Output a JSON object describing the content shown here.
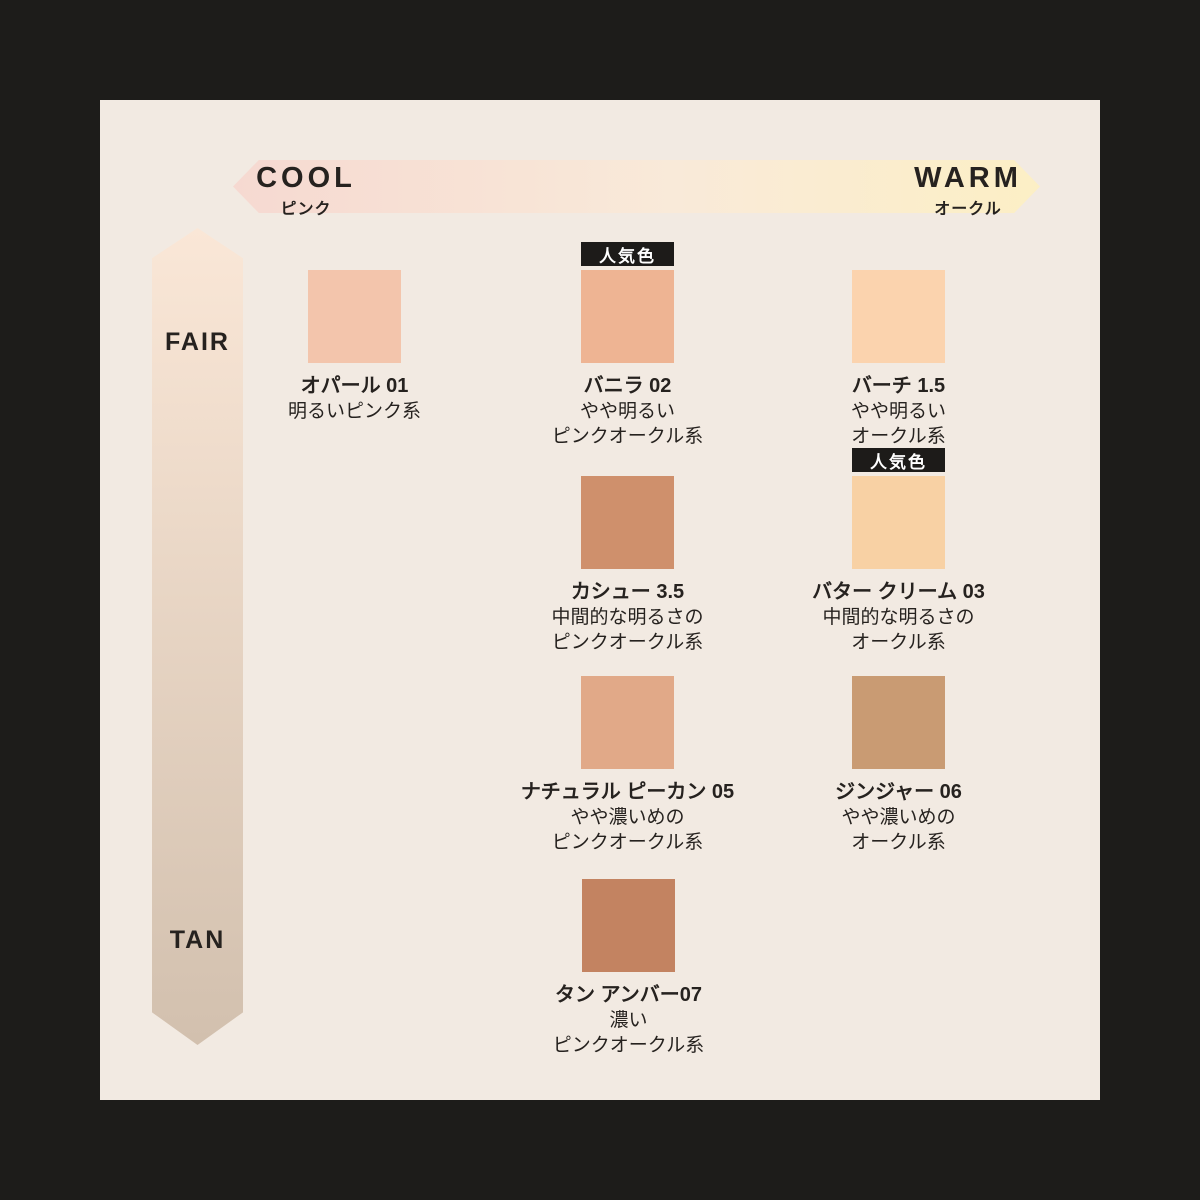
{
  "frame": {
    "bg": "#1d1c1a",
    "panel_bg": "#f2eae2",
    "text_color": "#26221f"
  },
  "axes": {
    "horizontal": {
      "left_label": "COOL",
      "left_sublabel": "ピンク",
      "right_label": "WARM",
      "right_sublabel": "オークル",
      "gradient_left": "#f6d9d1",
      "gradient_mid": "#f9ead9",
      "gradient_right": "#fcefc5"
    },
    "vertical": {
      "top_label": "FAIR",
      "bottom_label": "TAN",
      "gradient_top": "#fae7d7",
      "gradient_bottom": "#d2c0ae"
    }
  },
  "badge_label": "人気色",
  "shades": [
    {
      "name": "オパール 01",
      "desc": [
        "明るいピンク系"
      ],
      "color": "#f3c5ac",
      "popular": false
    },
    {
      "name": "バニラ 02",
      "desc": [
        "やや明るい",
        "ピンクオークル系"
      ],
      "color": "#eeb493",
      "popular": true
    },
    {
      "name": "バーチ 1.5",
      "desc": [
        "やや明るい",
        "オークル系"
      ],
      "color": "#fbd3ae",
      "popular": false
    },
    {
      "name": "カシュー 3.5",
      "desc": [
        "中間的な明るさの",
        "ピンクオークル系"
      ],
      "color": "#cf906c",
      "popular": false
    },
    {
      "name": "バター クリーム 03",
      "desc": [
        "中間的な明るさの",
        "オークル系"
      ],
      "color": "#f8d1a4",
      "popular": true
    },
    {
      "name": "ナチュラル ピーカン 05",
      "desc": [
        "やや濃いめの",
        "ピンクオークル系"
      ],
      "color": "#e1a988",
      "popular": false
    },
    {
      "name": "ジンジャー 06",
      "desc": [
        "やや濃いめの",
        "オークル系"
      ],
      "color": "#c99b73",
      "popular": false
    },
    {
      "name": "タン アンバー07",
      "desc": [
        "濃い",
        "ピンクオークル系"
      ],
      "color": "#c38361",
      "popular": false
    }
  ]
}
